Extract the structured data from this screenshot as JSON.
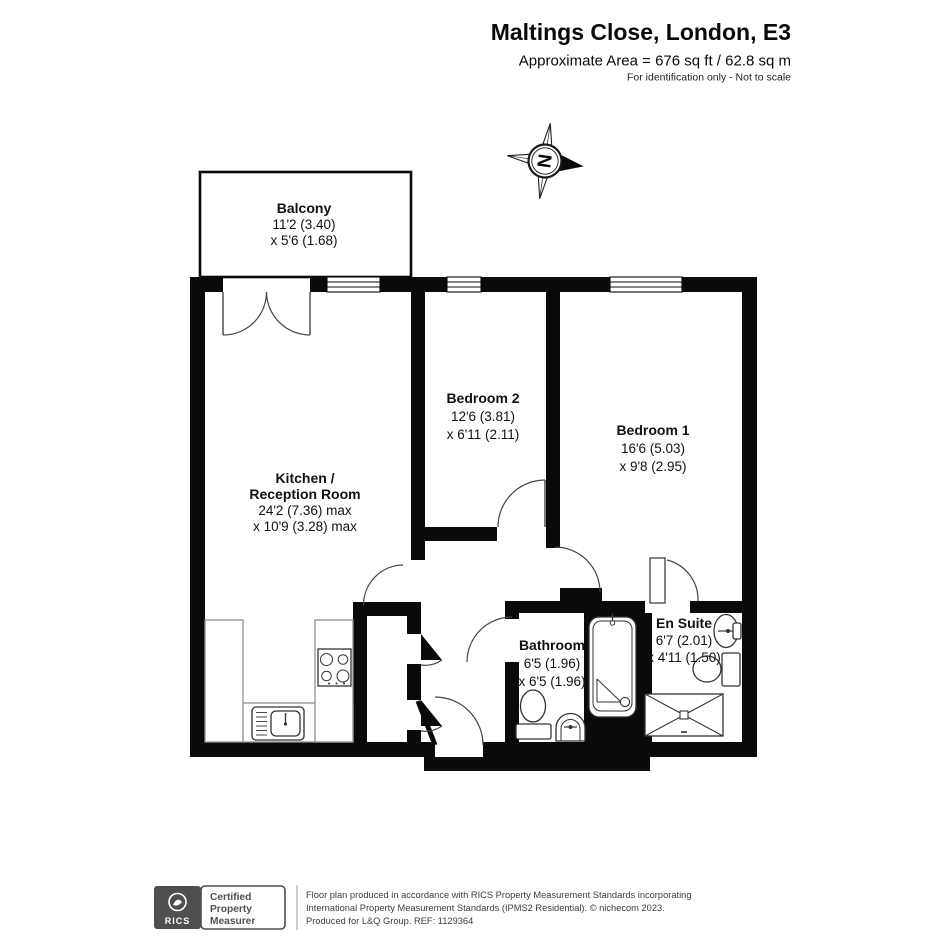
{
  "header": {
    "title": "Maltings Close, London, E3",
    "area": "Approximate Area = 676 sq ft / 62.8 sq m",
    "note": "For identification only - Not to scale"
  },
  "compass": {
    "north_label": "N"
  },
  "rooms": {
    "balcony": {
      "name": "Balcony",
      "dim1": "11'2 (3.40)",
      "dim2": "x 5'6 (1.68)"
    },
    "kitchen": {
      "name": "Kitchen /",
      "name2": "Reception Room",
      "dim1": "24'2 (7.36) max",
      "dim2": "x 10'9 (3.28) max"
    },
    "bedroom2": {
      "name": "Bedroom 2",
      "dim1": "12'6 (3.81)",
      "dim2": "x 6'11 (2.11)"
    },
    "bedroom1": {
      "name": "Bedroom 1",
      "dim1": "16'6 (5.03)",
      "dim2": "x 9'8 (2.95)"
    },
    "bathroom": {
      "name": "Bathroom",
      "dim1": "6'5 (1.96)",
      "dim2": "x 6'5 (1.96)"
    },
    "ensuite": {
      "name": "En Suite",
      "dim1": "6'7 (2.01)",
      "dim2": "x 4'11 (1.50)"
    }
  },
  "footer": {
    "rics_label": "RICS",
    "cert_line1": "Certified",
    "cert_line2": "Property",
    "cert_line3": "Measurer",
    "disclaimer_line1": "Floor plan produced in accordance with RICS Property Measurement Standards incorporating",
    "disclaimer_line2": "International Property Measurement Standards (IPMS2 Residential).   © nichecom 2023.",
    "disclaimer_line3": "Produced for L&Q Group.   REF:  1129364"
  },
  "colors": {
    "wall": "#0a0a0a",
    "badge_gray": "#4f4f4f"
  }
}
